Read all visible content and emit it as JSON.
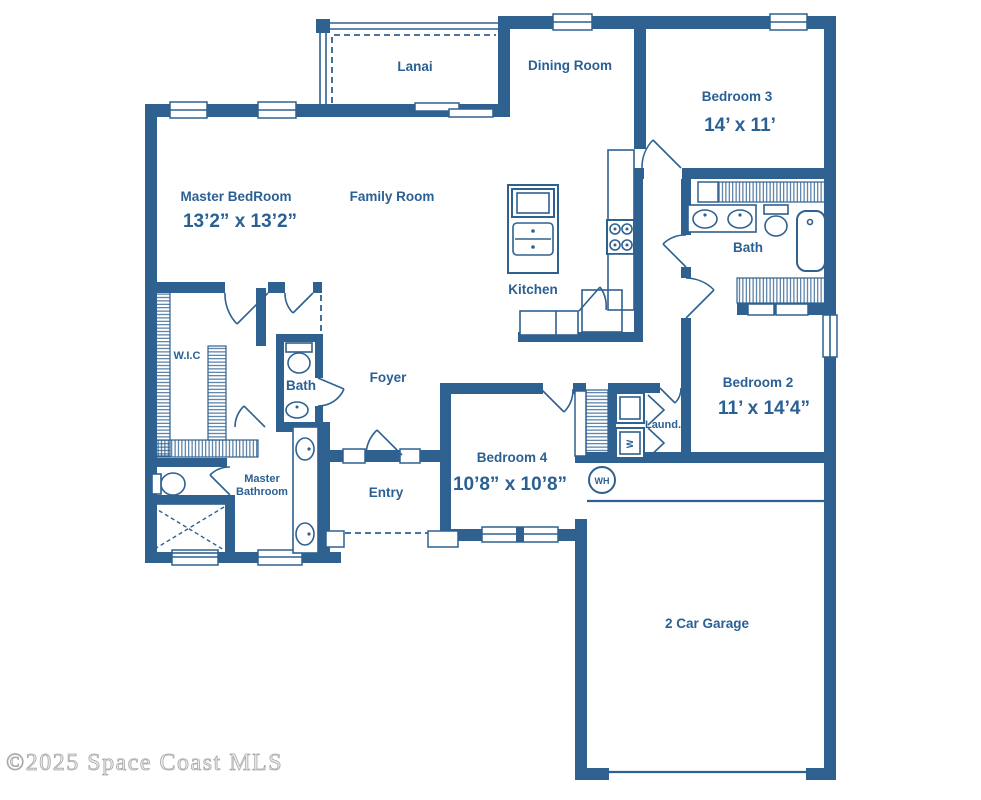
{
  "watermark": "©2025 Space Coast MLS",
  "colors": {
    "wall": "#2e6190",
    "label_text": "#2b6094",
    "watermark_gray": "#cccccc",
    "background": "#ffffff"
  },
  "rooms": {
    "lanai": {
      "label": "Lanai"
    },
    "dining": {
      "label": "Dining Room"
    },
    "bedroom3": {
      "label": "Bedroom 3",
      "dims": "14’ x 11’"
    },
    "master_bedroom": {
      "label": "Master BedRoom",
      "dims": "13’2” x 13’2”"
    },
    "family": {
      "label": "Family Room"
    },
    "kitchen": {
      "label": "Kitchen"
    },
    "bath_hall_right": {
      "label": "Bath"
    },
    "bedroom2": {
      "label": "Bedroom 2",
      "dims": "11’ x 14’4”"
    },
    "wic": {
      "label": "W.I.C"
    },
    "hall_bath": {
      "label": "Bath"
    },
    "foyer": {
      "label": "Foyer"
    },
    "master_bath": {
      "label_line1": "Master",
      "label_line2": "Bathroom"
    },
    "entry": {
      "label": "Entry"
    },
    "bedroom4": {
      "label": "Bedroom 4",
      "dims": "10’8” x 10’8”"
    },
    "laundry": {
      "label": "Laund."
    },
    "garage": {
      "label": "2 Car Garage"
    }
  },
  "fixtures": {
    "water_heater_label": "WH",
    "washer_label": "W"
  }
}
